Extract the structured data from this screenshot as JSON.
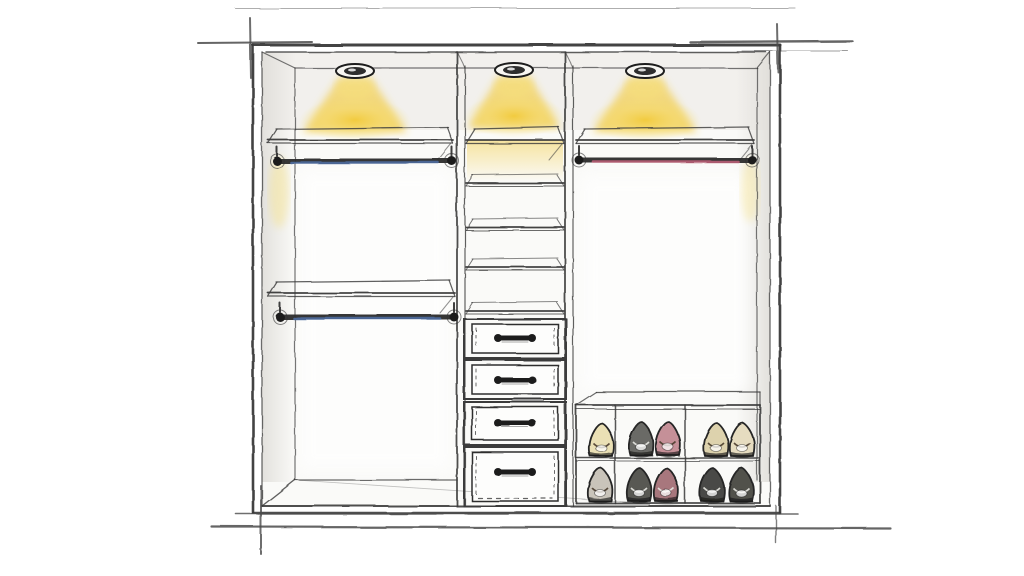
{
  "colors": {
    "paper": "#ffffff",
    "ink": "#3a3a3a",
    "ink_dark": "#222222",
    "ink_light": "#8a8a8a",
    "wall_wash": "#eceae6",
    "glow_core": "#f2c832",
    "glow_soft": "#f7e07a",
    "rod_blue": "#4f6fa5",
    "rod_pink": "#c06078",
    "metal_dark": "#1f1f1f",
    "drawer_face": "#fdfdfc"
  },
  "frame": {
    "outer": {
      "x1": 253,
      "y1": 45,
      "x2": 780,
      "y2": 513
    },
    "inner": {
      "x1": 262,
      "y1": 52,
      "x2": 770,
      "y2": 506
    },
    "interior": {
      "left": 295,
      "right": 757,
      "ceiling": 68,
      "floor": 480
    },
    "dividers": [
      {
        "name": "divider-left",
        "xa": 457,
        "xb": 465
      },
      {
        "name": "divider-right",
        "xa": 565,
        "xb": 573
      }
    ]
  },
  "lights": [
    {
      "name": "ceiling-light-left",
      "cx": 355,
      "cy": 71,
      "cone_half": 52,
      "cone_bottom": 132
    },
    {
      "name": "ceiling-light-middle",
      "cx": 514,
      "cy": 70,
      "cone_half": 46,
      "cone_bottom": 128
    },
    {
      "name": "ceiling-light-right",
      "cx": 645,
      "cy": 71,
      "cone_half": 52,
      "cone_bottom": 132
    }
  ],
  "shelves": [
    {
      "name": "top-shelf-left",
      "x1": 268,
      "x2": 453,
      "y": 140
    },
    {
      "name": "top-shelf-middle",
      "x1": 466,
      "x2": 564,
      "y": 140
    },
    {
      "name": "top-shelf-right",
      "x1": 576,
      "x2": 754,
      "y": 140
    },
    {
      "name": "middle-shelf-left",
      "x1": 268,
      "x2": 455,
      "y": 293
    }
  ],
  "mid_column_shelves": {
    "x1": 466,
    "x2": 564,
    "ys": [
      183,
      227,
      267,
      311
    ]
  },
  "rods": [
    {
      "name": "hanging-rod-left-upper",
      "x1": 277,
      "x2": 452,
      "y": 161,
      "tint": "rod_blue"
    },
    {
      "name": "hanging-rod-left-lower",
      "x1": 280,
      "x2": 454,
      "y": 317,
      "tint": "rod_blue"
    },
    {
      "name": "hanging-rod-right",
      "x1": 579,
      "x2": 752,
      "y": 160,
      "tint": "rod_pink"
    }
  ],
  "drawer_unit": {
    "x1": 464,
    "x2": 566,
    "face_inset": 8,
    "drawers": [
      {
        "name": "drawer-1",
        "y1": 319,
        "y2": 358,
        "handle_y": 338
      },
      {
        "name": "drawer-2",
        "y1": 360,
        "y2": 399,
        "handle_y": 380
      },
      {
        "name": "drawer-3",
        "y1": 402,
        "y2": 445,
        "handle_y": 423
      },
      {
        "name": "drawer-4",
        "y1": 447,
        "y2": 506,
        "handle_y": 472
      }
    ],
    "handle": {
      "width": 34,
      "bar_h": 5,
      "knob_r": 4
    }
  },
  "shoe_rack": {
    "x1": 576,
    "x2": 760,
    "top": 405,
    "bottom": 503,
    "shelf_y": 458,
    "dividers": [
      615,
      685
    ],
    "back_top_y": 392
  },
  "shoes": [
    {
      "name": "shoe",
      "cx": 601,
      "base": 456,
      "fill": "#eae0b5",
      "dark": false
    },
    {
      "name": "shoe",
      "cx": 641,
      "base": 455,
      "fill": "#6b6b66",
      "dark": true
    },
    {
      "name": "shoe",
      "cx": 668,
      "base": 455,
      "fill": "#c59098",
      "dark": false
    },
    {
      "name": "shoe",
      "cx": 716,
      "base": 456,
      "fill": "#ddd2ad",
      "dark": false
    },
    {
      "name": "shoe",
      "cx": 742,
      "base": 456,
      "fill": "#e6dcc0",
      "dark": false
    },
    {
      "name": "shoe",
      "cx": 600,
      "base": 501,
      "fill": "#c9c4ba",
      "dark": false
    },
    {
      "name": "shoe",
      "cx": 639,
      "base": 501,
      "fill": "#585853",
      "dark": true
    },
    {
      "name": "shoe",
      "cx": 666,
      "base": 501,
      "fill": "#a8777d",
      "dark": true
    },
    {
      "name": "shoe",
      "cx": 712,
      "base": 501,
      "fill": "#4a4a46",
      "dark": true
    },
    {
      "name": "shoe",
      "cx": 741,
      "base": 501,
      "fill": "#51514c",
      "dark": true
    }
  ],
  "construction_lines": [
    {
      "x1": 235,
      "y1": 8,
      "x2": 795,
      "y2": 8,
      "w": 1.1,
      "o": 0.45
    },
    {
      "x1": 198,
      "y1": 43,
      "x2": 312,
      "y2": 42,
      "w": 2.0,
      "o": 0.85
    },
    {
      "x1": 250,
      "y1": 18,
      "x2": 251,
      "y2": 78,
      "w": 2.0,
      "o": 0.8
    },
    {
      "x1": 690,
      "y1": 42,
      "x2": 852,
      "y2": 41,
      "w": 2.4,
      "o": 0.85
    },
    {
      "x1": 742,
      "y1": 51,
      "x2": 848,
      "y2": 51,
      "w": 1.0,
      "o": 0.55
    },
    {
      "x1": 777,
      "y1": 24,
      "x2": 778,
      "y2": 72,
      "w": 2.0,
      "o": 0.8
    },
    {
      "x1": 236,
      "y1": 514,
      "x2": 798,
      "y2": 514,
      "w": 1.6,
      "o": 0.8
    },
    {
      "x1": 212,
      "y1": 527,
      "x2": 890,
      "y2": 528,
      "w": 2.2,
      "o": 0.85
    },
    {
      "x1": 261,
      "y1": 486,
      "x2": 261,
      "y2": 554,
      "w": 2.0,
      "o": 0.8
    },
    {
      "x1": 776,
      "y1": 506,
      "x2": 776,
      "y2": 543,
      "w": 1.4,
      "o": 0.7
    }
  ]
}
